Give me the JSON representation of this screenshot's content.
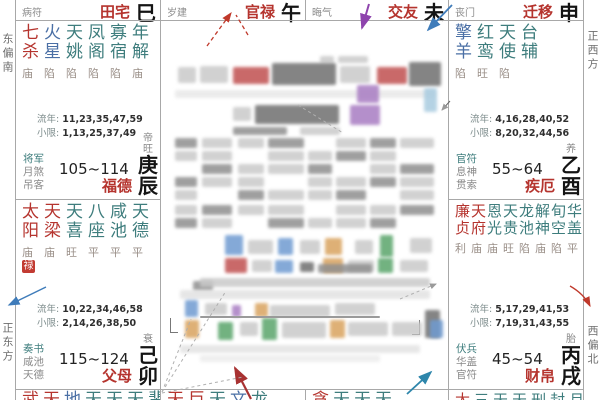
{
  "colors": {
    "star_major": "#b5342e",
    "star_minor": "#3e7d7d",
    "star_malefic": "#4a6fa5",
    "palace_name": "#b5342e",
    "branch": "#141414",
    "status": "#9a8f88",
    "god_primary": "#3e7d7d",
    "god_secondary": "#8a8a8a",
    "numbers": "#2f2f2f",
    "number_label": "#7d8c8c",
    "border": "#a8a8a8",
    "trans_badge_bg": "#c23b32",
    "arrow_red": "#c0392b",
    "arrow_purple": "#8e44ad",
    "arrow_blue": "#3f7cba",
    "arrow_teal": "#2e86ab",
    "arrow_darkred": "#a83232"
  },
  "compass": {
    "left_top": "东偏南",
    "left_bottom": "正东方",
    "right_top": "正西方",
    "right_bottom": "西偏北"
  },
  "top_band": [
    {
      "god": "病符",
      "palace": "田宅",
      "branch": "巳"
    },
    {
      "god": "岁建",
      "palace": "官禄",
      "branch": "午"
    },
    {
      "god": "晦气",
      "palace": "交友",
      "branch": "未"
    },
    {
      "god": "丧门",
      "palace": "迁移",
      "branch": "申"
    }
  ],
  "palaces": [
    {
      "stars": [
        {
          "name": "七杀",
          "color": "red",
          "status": "庙"
        },
        {
          "name": "火星",
          "color": "blue",
          "status": "陷"
        },
        {
          "name": "天姚",
          "color": "teal",
          "status": "陷"
        },
        {
          "name": "凤阁",
          "color": "teal",
          "status": "陷"
        },
        {
          "name": "寡宿",
          "color": "teal",
          "status": "陷"
        },
        {
          "name": "年解",
          "color": "teal",
          "status": "庙"
        }
      ],
      "liunian": {
        "label": "流年",
        "values": "11,23,35,47,59"
      },
      "xiaoxian": {
        "label": "小限",
        "values": "1,13,25,37,49"
      },
      "gods": [
        "将军",
        "月煞",
        "吊客"
      ],
      "range": "105~114",
      "palace_name": "福德",
      "stage": "帝旺",
      "stem_branch": "庚辰"
    },
    {
      "stars": [
        {
          "name": "擎羊",
          "color": "blue",
          "status": "陷"
        },
        {
          "name": "红鸾",
          "color": "teal",
          "status": "旺"
        },
        {
          "name": "天使",
          "color": "teal",
          "status": "陷"
        },
        {
          "name": "台辅",
          "color": "teal",
          "status": ""
        }
      ],
      "liunian": {
        "label": "流年",
        "values": "4,16,28,40,52"
      },
      "xiaoxian": {
        "label": "小限",
        "values": "8,20,32,44,56"
      },
      "gods": [
        "官符",
        "息神",
        "贯索"
      ],
      "range": "55~64",
      "palace_name": "疾厄",
      "stage": "养",
      "stem_branch": "乙酉"
    },
    {
      "stars": [
        {
          "name": "太阳",
          "color": "red",
          "status": "庙",
          "trans": "禄"
        },
        {
          "name": "天梁",
          "color": "red",
          "status": "庙"
        },
        {
          "name": "天喜",
          "color": "teal",
          "status": "旺"
        },
        {
          "name": "八座",
          "color": "teal",
          "status": "平"
        },
        {
          "name": "咸池",
          "color": "teal",
          "status": "平"
        },
        {
          "name": "天德",
          "color": "teal",
          "status": "平"
        }
      ],
      "liunian": {
        "label": "流年",
        "values": "10,22,34,46,58"
      },
      "xiaoxian": {
        "label": "小限",
        "values": "2,14,26,38,50"
      },
      "gods": [
        "奏书",
        "咸池",
        "天德"
      ],
      "range": "115~124",
      "palace_name": "父母",
      "stage": "衰",
      "stem_branch": "己卯"
    },
    {
      "stars": [
        {
          "name": "廉贞",
          "color": "red",
          "status": "利"
        },
        {
          "name": "天府",
          "color": "red",
          "status": "庙"
        },
        {
          "name": "恩光",
          "color": "teal",
          "status": "庙"
        },
        {
          "name": "天贵",
          "color": "teal",
          "status": "旺"
        },
        {
          "name": "龙池",
          "color": "teal",
          "status": "陷"
        },
        {
          "name": "解神",
          "color": "teal",
          "status": "庙"
        },
        {
          "name": "旬空",
          "color": "teal",
          "status": "陷"
        },
        {
          "name": "华盖",
          "color": "teal",
          "status": "平"
        }
      ],
      "liunian": {
        "label": "流年",
        "values": "5,17,29,41,53"
      },
      "xiaoxian": {
        "label": "小限",
        "values": "7,19,31,43,55"
      },
      "gods": [
        "伏兵",
        "华盖",
        "官符"
      ],
      "range": "45~54",
      "palace_name": "财帛",
      "stage": "胎",
      "stem_branch": "丙戌"
    }
  ],
  "bottom_row": [
    {
      "star_tops": [
        {
          "ch": "武",
          "color": "red"
        },
        {
          "ch": "天",
          "color": "red"
        },
        {
          "ch": "地",
          "color": "blue"
        },
        {
          "ch": "天",
          "color": "teal"
        },
        {
          "ch": "天",
          "color": "teal"
        },
        {
          "ch": "天",
          "color": "teal"
        },
        {
          "ch": "蜚",
          "color": "teal"
        }
      ]
    },
    {
      "star_tops": [
        {
          "ch": "天",
          "color": "red"
        },
        {
          "ch": "巨",
          "color": "red"
        },
        {
          "ch": "天",
          "color": "teal"
        },
        {
          "ch": "文",
          "color": "blue"
        },
        {
          "ch": "龙",
          "color": "teal"
        }
      ]
    },
    {
      "star_tops": [
        {
          "ch": "贪",
          "color": "red"
        },
        {
          "ch": "天",
          "color": "teal"
        },
        {
          "ch": "天",
          "color": "teal"
        },
        {
          "ch": "天",
          "color": "teal"
        }
      ]
    },
    {
      "star_tops": [
        {
          "ch": "太",
          "color": "red"
        },
        {
          "ch": "三",
          "color": "teal"
        },
        {
          "ch": "天",
          "color": "teal"
        },
        {
          "ch": "天",
          "color": "teal"
        },
        {
          "ch": "刑",
          "color": "teal"
        },
        {
          "ch": "封",
          "color": "teal"
        },
        {
          "ch": "月",
          "color": "teal"
        }
      ]
    }
  ],
  "center_panel": {
    "redacted": true
  }
}
